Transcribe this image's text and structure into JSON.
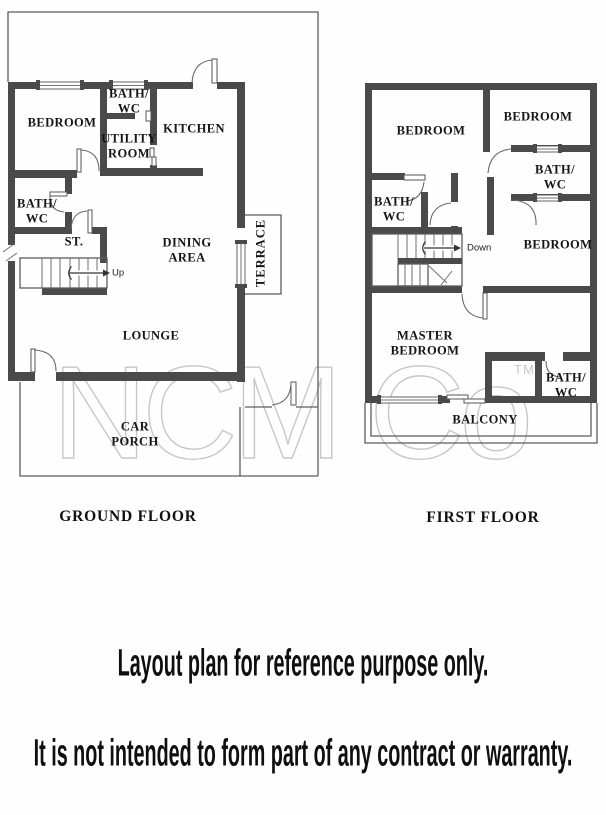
{
  "watermark": {
    "text": "NCM Co",
    "tm": "TM"
  },
  "ground_floor": {
    "title": "GROUND FLOOR",
    "stair_label": "Up",
    "rooms": {
      "bedroom": "BEDROOM",
      "bath_wc_top": "BATH/\nWC",
      "utility_room": "UTILITY\nROOM",
      "kitchen": "KITCHEN",
      "bath_wc_mid": "BATH/\nWC",
      "store": "ST.",
      "dining_area": "DINING\nAREA",
      "terrace": "TERRACE",
      "lounge": "LOUNGE",
      "car_porch": "CAR\nPORCH"
    }
  },
  "first_floor": {
    "title": "FIRST FLOOR",
    "stair_label": "Down",
    "rooms": {
      "bedroom_top_left": "BEDROOM",
      "bedroom_top_right": "BEDROOM",
      "bath_wc_right": "BATH/\nWC",
      "bath_wc_left": "BATH/\nWC",
      "bedroom_mid_right": "BEDROOM",
      "master_bedroom": "MASTER\nBEDROOM",
      "bath_wc_bottom": "BATH/\nWC",
      "balcony": "BALCONY"
    }
  },
  "disclaimer": {
    "line1": "Layout plan for reference purpose only.",
    "line2": "It is not intended to form part of any contract or warranty."
  },
  "colors": {
    "wall": "#4a4a4a",
    "line": "#5d5d5d",
    "label_text": "#151515",
    "watermark": "#c7c7c7",
    "background": "#fefefe"
  }
}
